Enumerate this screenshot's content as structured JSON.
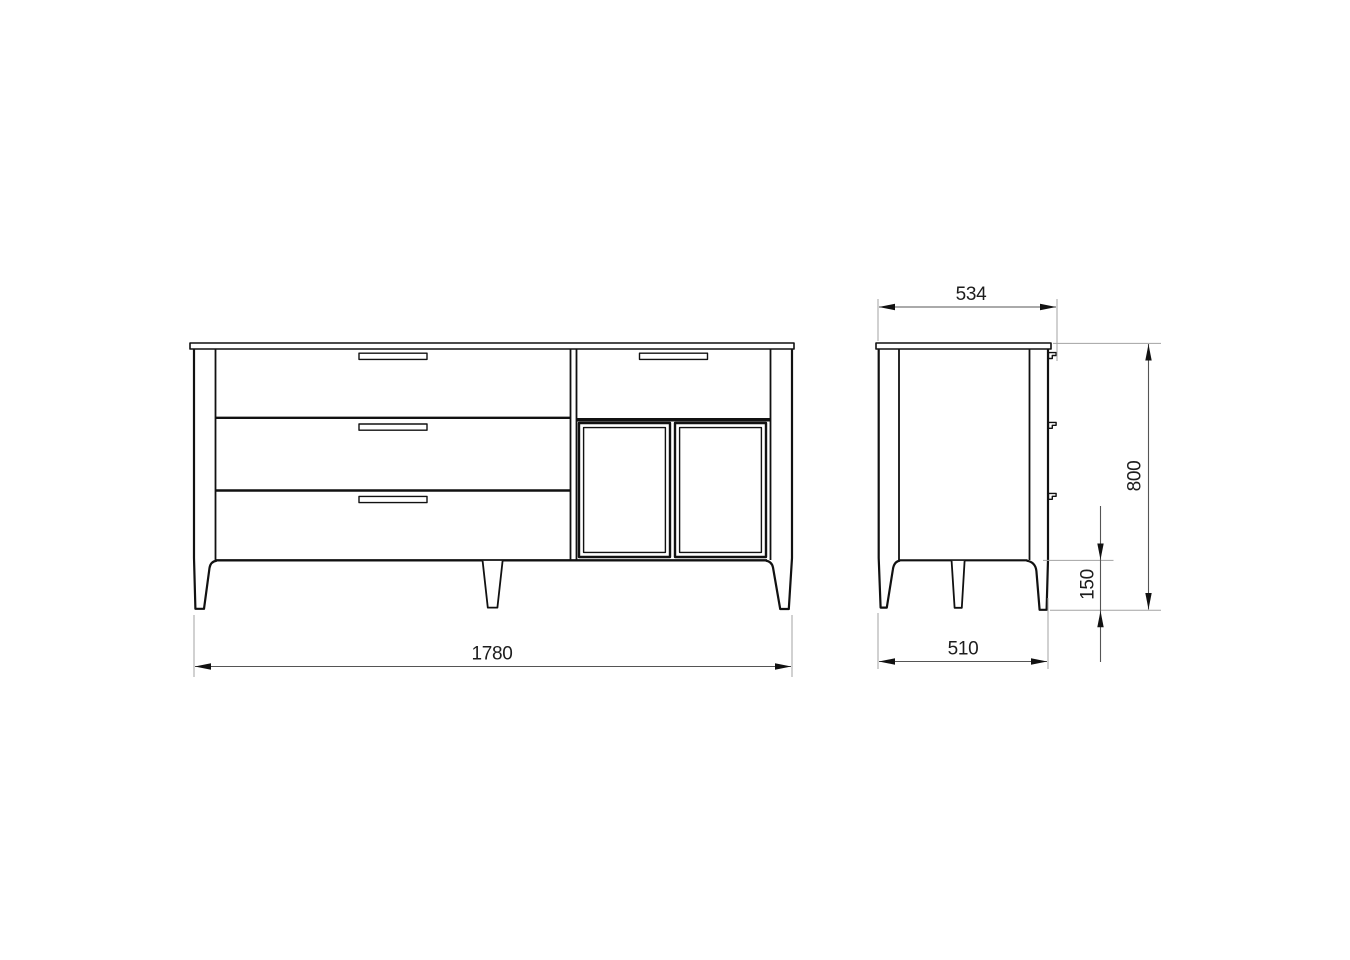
{
  "dimensions": {
    "overall_width": "1780",
    "depth_with_handles": "534",
    "base_depth": "510",
    "overall_height": "800",
    "leg_height": "150"
  },
  "colors": {
    "background": "#ffffff",
    "object_line": "#111111",
    "dimension_line": "#555555",
    "extension_line": "#a3a3a3",
    "text": "#1d1d1d"
  }
}
